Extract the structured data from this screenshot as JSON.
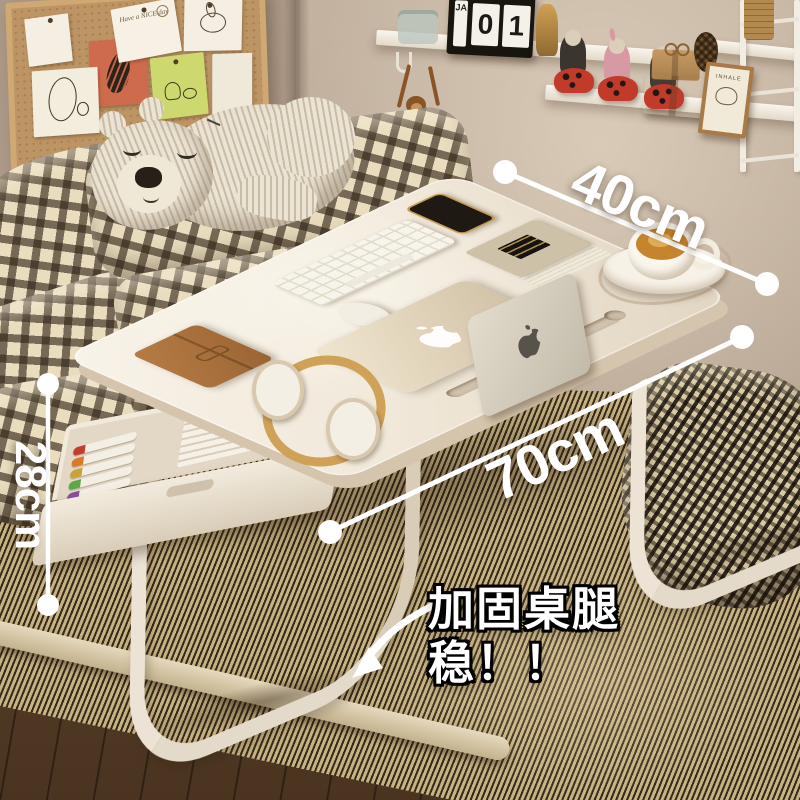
{
  "annotations": {
    "depth_label": "40cm",
    "length_label": "70cm",
    "height_label": "28cm",
    "callout_line1": "加固桌腿",
    "callout_line2": "稳！！"
  },
  "wall_decor": {
    "corkboard_note": "Have a NICE day",
    "calendar_month": "JA",
    "calendar_day_digits": [
      "0",
      "1"
    ],
    "frame_text": "INHALE"
  },
  "icons": {
    "laptop_logo": "apple-logo",
    "tablet_logo": "apple-logo"
  },
  "colors": {
    "wall": "#b9a795",
    "tabletop": "#f2ebdd",
    "table_edge": "#d5c5ad",
    "leg": "#ece3d4",
    "mat_light": "#b7a077",
    "mat_dark": "#44341f",
    "plaid_base": "#e9ddbe",
    "plaid_check": "#3a2c1c",
    "pillow_check_base": "#d9c9a2",
    "annotation_white": "#ffffff",
    "callout_outline": "#000000",
    "coffee": "#c5852e",
    "notebook_leather": "#a9713e",
    "cork": "#bd9565",
    "pen_caps": [
      "#c63b2f",
      "#d97a28",
      "#caa23a",
      "#5ca943",
      "#8a4f9e",
      "#3f6fb5",
      "#2f9e8f"
    ]
  }
}
